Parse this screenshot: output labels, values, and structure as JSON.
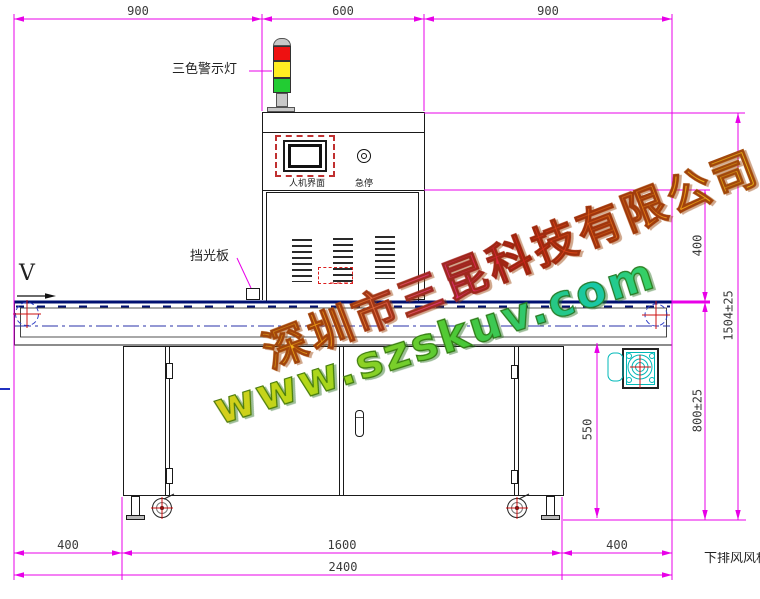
{
  "drawing": {
    "title_hint": "UV curing conveyor machine front-view CAD drawing",
    "labels": {
      "warning_light": "三色警示灯",
      "hmi": "人机界面",
      "estop": "急停",
      "shield": "挡光板",
      "direction": "V",
      "exhaust": "下排风风机"
    },
    "dims": {
      "top_left": "900",
      "top_mid": "600",
      "top_right": "900",
      "chamber_height": "400",
      "total_height": "1504±25",
      "belt_height": "800±25",
      "frame_height": "550",
      "bottom_left": "400",
      "bottom_mid": "1600",
      "bottom_right": "400",
      "total_length": "2400"
    },
    "watermark": {
      "company": "深圳市三昆科技有限公司",
      "website": "www.szskuv.com"
    },
    "colors": {
      "dimension_line": "#e800e8",
      "outline": "#1a1a1a",
      "belt_line": "#001070",
      "centerline": "#2830a8",
      "crosshair_red": "#cc1010",
      "lamp_red": "#ee1111",
      "lamp_yellow": "#ffee22",
      "lamp_green": "#22cc33",
      "motor_cyan": "#00b8b8"
    }
  }
}
